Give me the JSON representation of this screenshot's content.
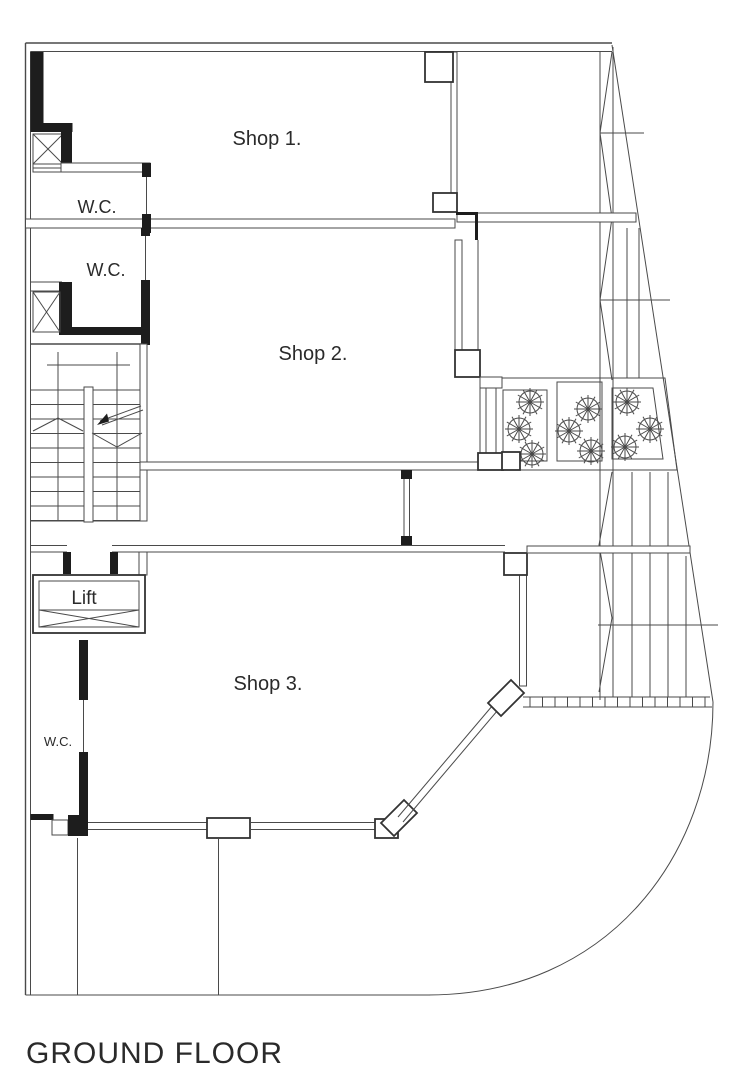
{
  "drawing": {
    "title": "GROUND FLOOR",
    "rooms": {
      "shop1": "Shop 1.",
      "shop2": "Shop 2.",
      "shop3": "Shop 3.",
      "wc1": "W.C.",
      "wc2": "W.C.",
      "wc3": "W.C.",
      "lift": "Lift"
    },
    "landscaping": {
      "plant_count": 9
    },
    "colors": {
      "line": "#4a4a4a",
      "wall": "#1d1d1d",
      "ink": "#2a2a2a",
      "background": "#ffffff"
    }
  }
}
